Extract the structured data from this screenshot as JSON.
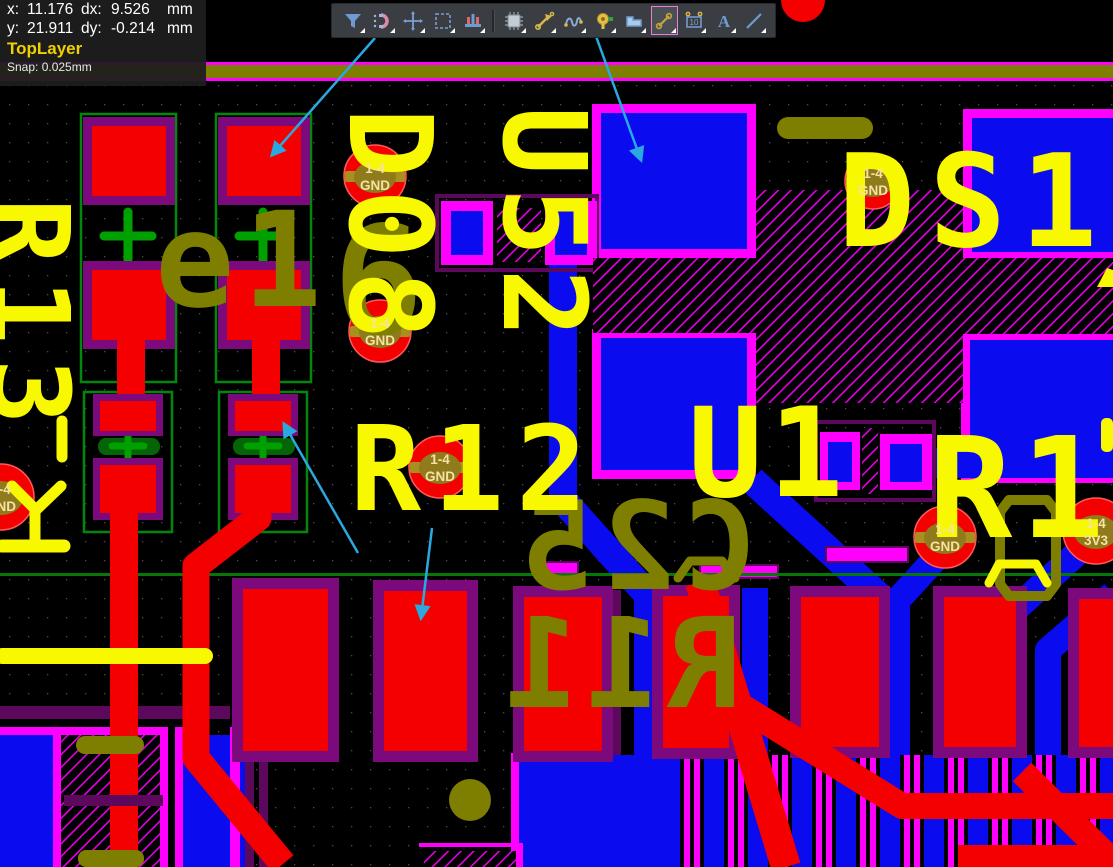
{
  "status_panel": {
    "x_label": "x:",
    "x_value": "11.176",
    "dx_label": "dx:",
    "dx_value": "9.526",
    "dx_unit": "mm",
    "y_label": "y:",
    "y_value": "21.911",
    "dy_label": "dy:",
    "dy_value": "-0.214",
    "dy_unit": "mm",
    "active_layer": "TopLayer",
    "snap": "Snap: 0.025mm"
  },
  "toolbar": {
    "icons": [
      "filter",
      "magnet",
      "crosshair",
      "marquee",
      "pad-array",
      "ic-chip",
      "route",
      "meander",
      "via",
      "copper-pour",
      "measure",
      "dimension",
      "text",
      "line"
    ],
    "active_icon": "measure",
    "text_icon_label": "A",
    "dimension_icon_label": "10"
  },
  "silkscreen": {
    "top": {
      "r12": "R12",
      "u1": "U1",
      "ds1": "DS1.",
      "r1": "R1",
      "r13": "R13",
      "col_d": "D08",
      "col_u": "U52"
    },
    "bottom": {
      "e1": "e1",
      "six": "6",
      "c25": "C25",
      "r11": "R11"
    }
  },
  "vias": [
    {
      "l1": "1-4",
      "l2": "GND"
    },
    {
      "l1": "1-4",
      "l2": "GND"
    },
    {
      "l1": "1-4",
      "l2": "GND"
    },
    {
      "l1": "1-4",
      "l2": "GND"
    },
    {
      "l1": "1-4",
      "l2": "GND"
    },
    {
      "l1": "1-4",
      "l2": "3V3"
    },
    {
      "l1": "1-4",
      "l2": "GND"
    }
  ],
  "colors": {
    "top_copper": "#f40000",
    "bottom_copper": "#0b0bf0",
    "multilayer_pad": "#ff00ff",
    "inner_pad_purple": "#7c0a7c",
    "top_silk": "#f8f800",
    "bottom_silk": "#7e7e00",
    "courtyard_green": "#00a000",
    "board_line_green": "#077807",
    "hatch_magenta": "#e400e4",
    "annotation_arrow": "#2aa9e0",
    "via_label": "#f6e3a4",
    "layer_indicator": "#f0d000"
  }
}
